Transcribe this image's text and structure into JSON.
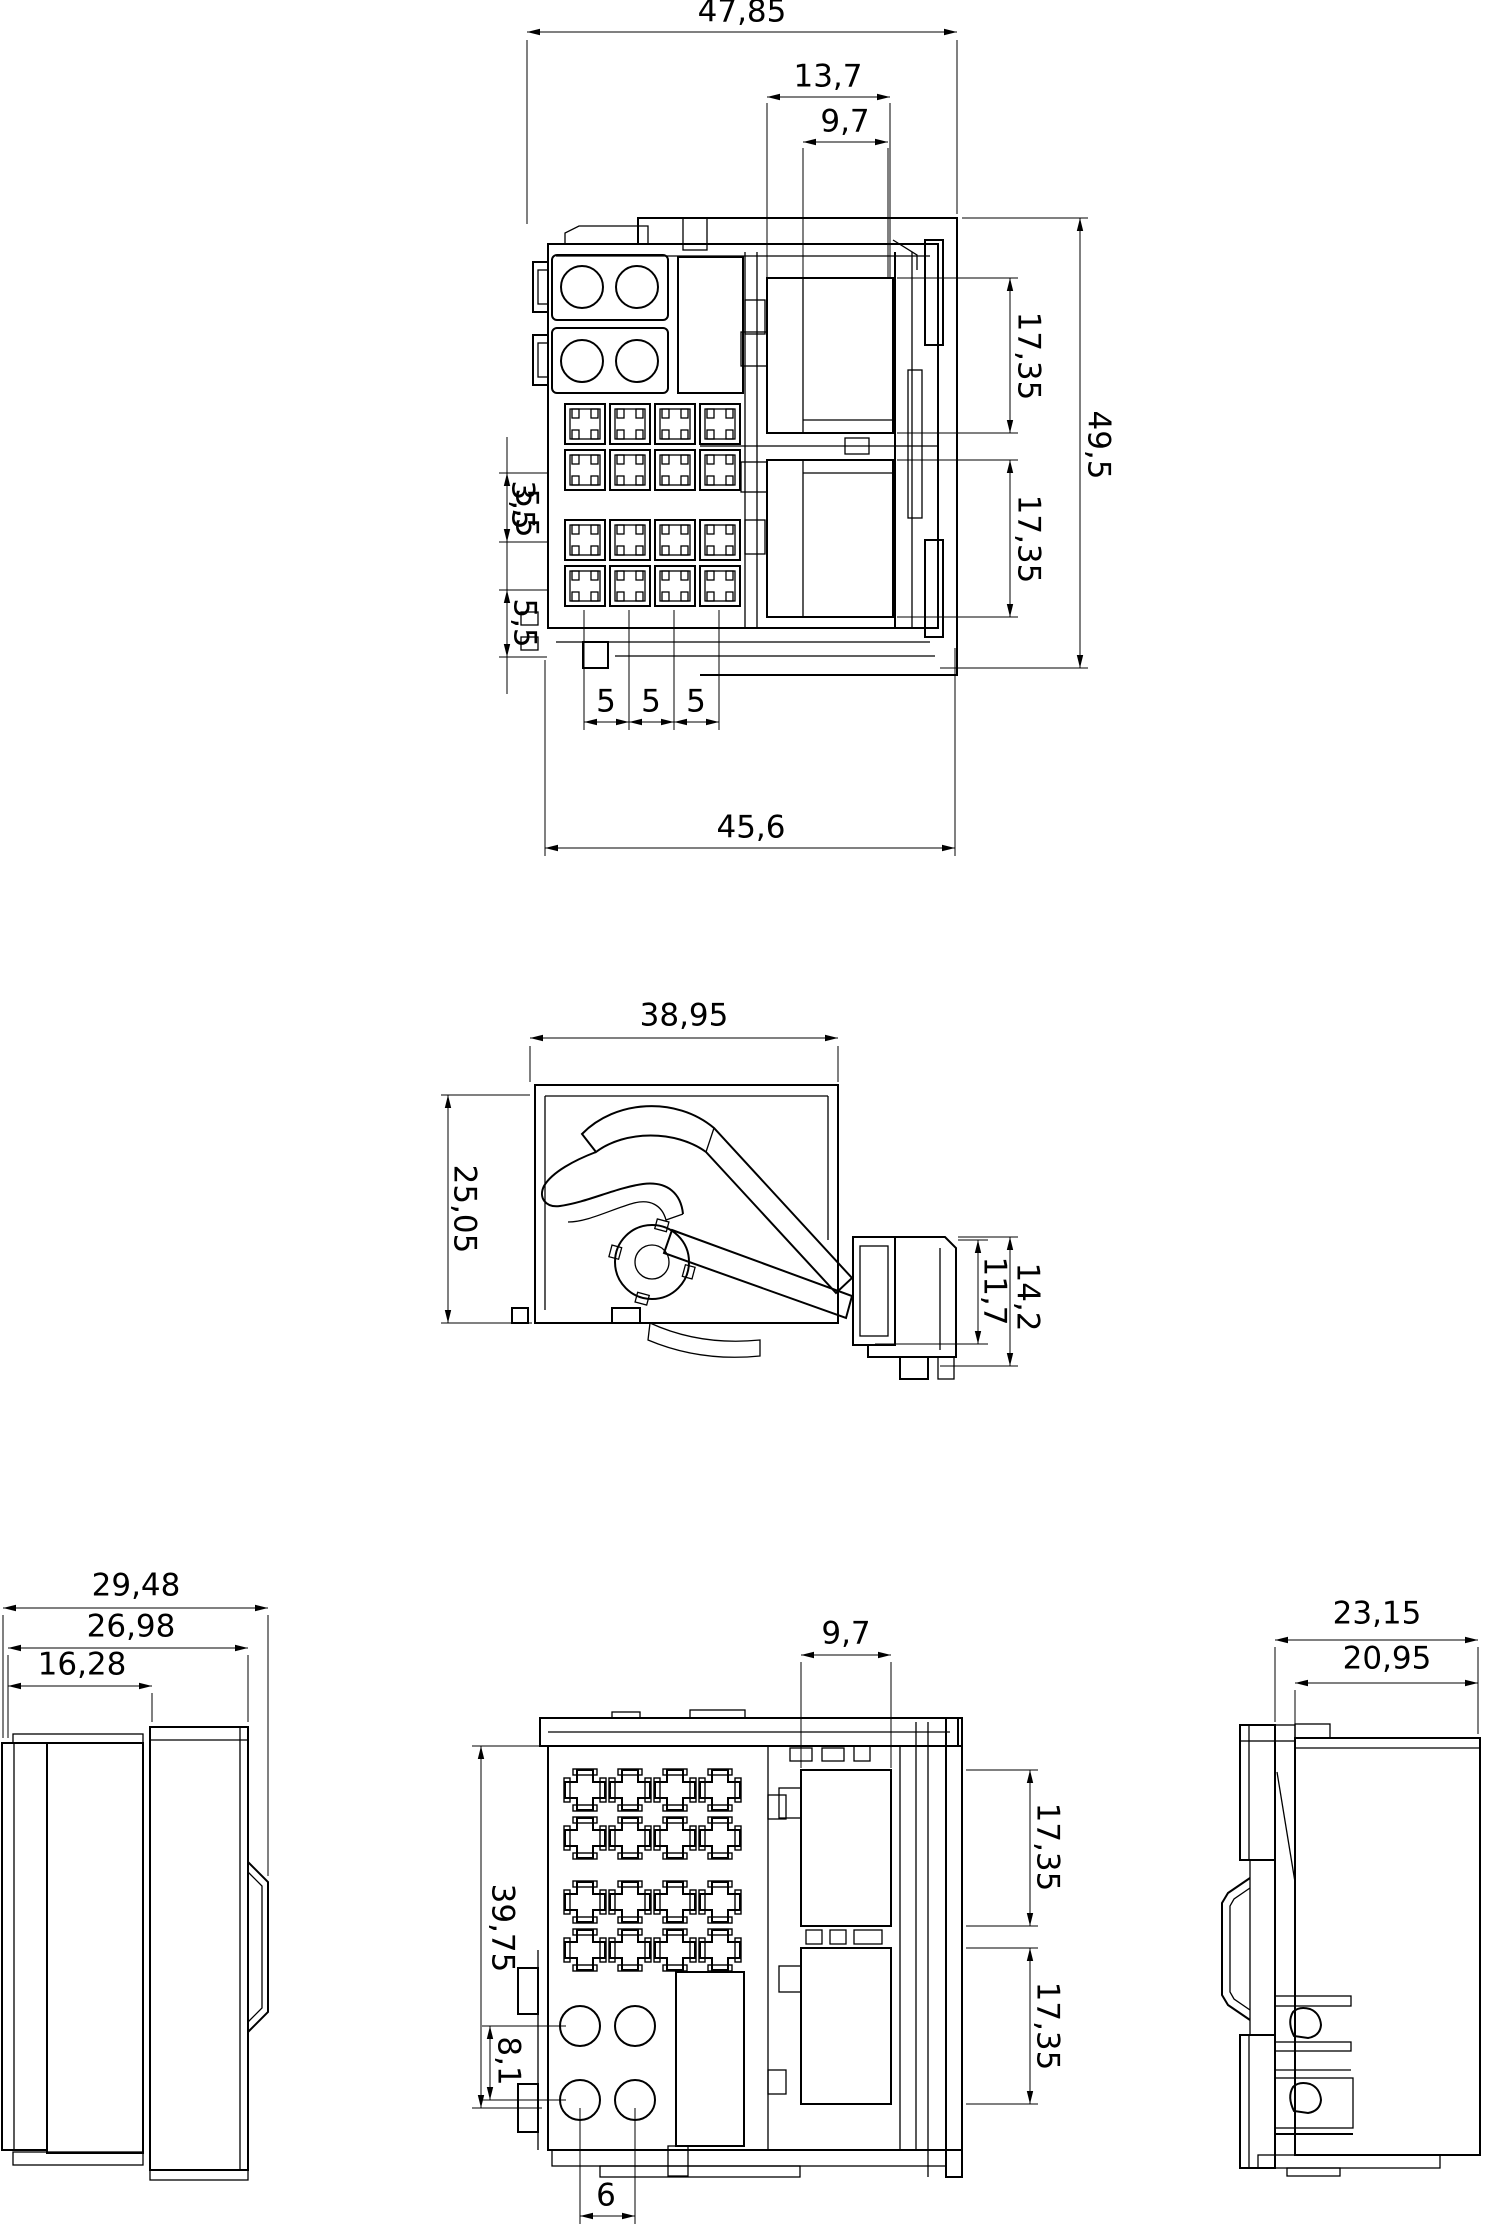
{
  "drawing": {
    "background": "#ffffff",
    "line_color": "#000000",
    "text_color": "#000000",
    "decimal_separator": ","
  },
  "front_view": {
    "dims": {
      "overall_width": "47,85",
      "cavity_width": "13,7",
      "cavity_inner_width": "9,7",
      "upper_cavity_height": "17,35",
      "lower_cavity_height": "17,35",
      "overall_height": "49,5",
      "row_pitch_overlap_a": "3,5",
      "row_pitch_overlap_b": "5,5",
      "row_pitch": "5,5",
      "terminal_pitch_1": "5",
      "terminal_pitch_2": "5",
      "terminal_pitch_3": "5",
      "body_width": "45,6"
    }
  },
  "side_view": {
    "dims": {
      "lever_width": "38,95",
      "body_height": "25,05",
      "latch_outer_height": "14,2",
      "latch_inner_height": "11,7"
    }
  },
  "left_side_view": {
    "dims": {
      "overall_depth": "29,48",
      "mid_depth": "26,98",
      "front_depth": "16,28"
    }
  },
  "rear_view": {
    "dims": {
      "cavity_inner_width": "9,7",
      "body_height": "39,75",
      "upper_cavity_height": "17,35",
      "lower_cavity_height": "17,35",
      "power_row_pitch": "8,1",
      "power_col_pitch": "6"
    }
  },
  "right_side_view": {
    "dims": {
      "overall_depth": "23,15",
      "inner_depth": "20,95"
    }
  }
}
